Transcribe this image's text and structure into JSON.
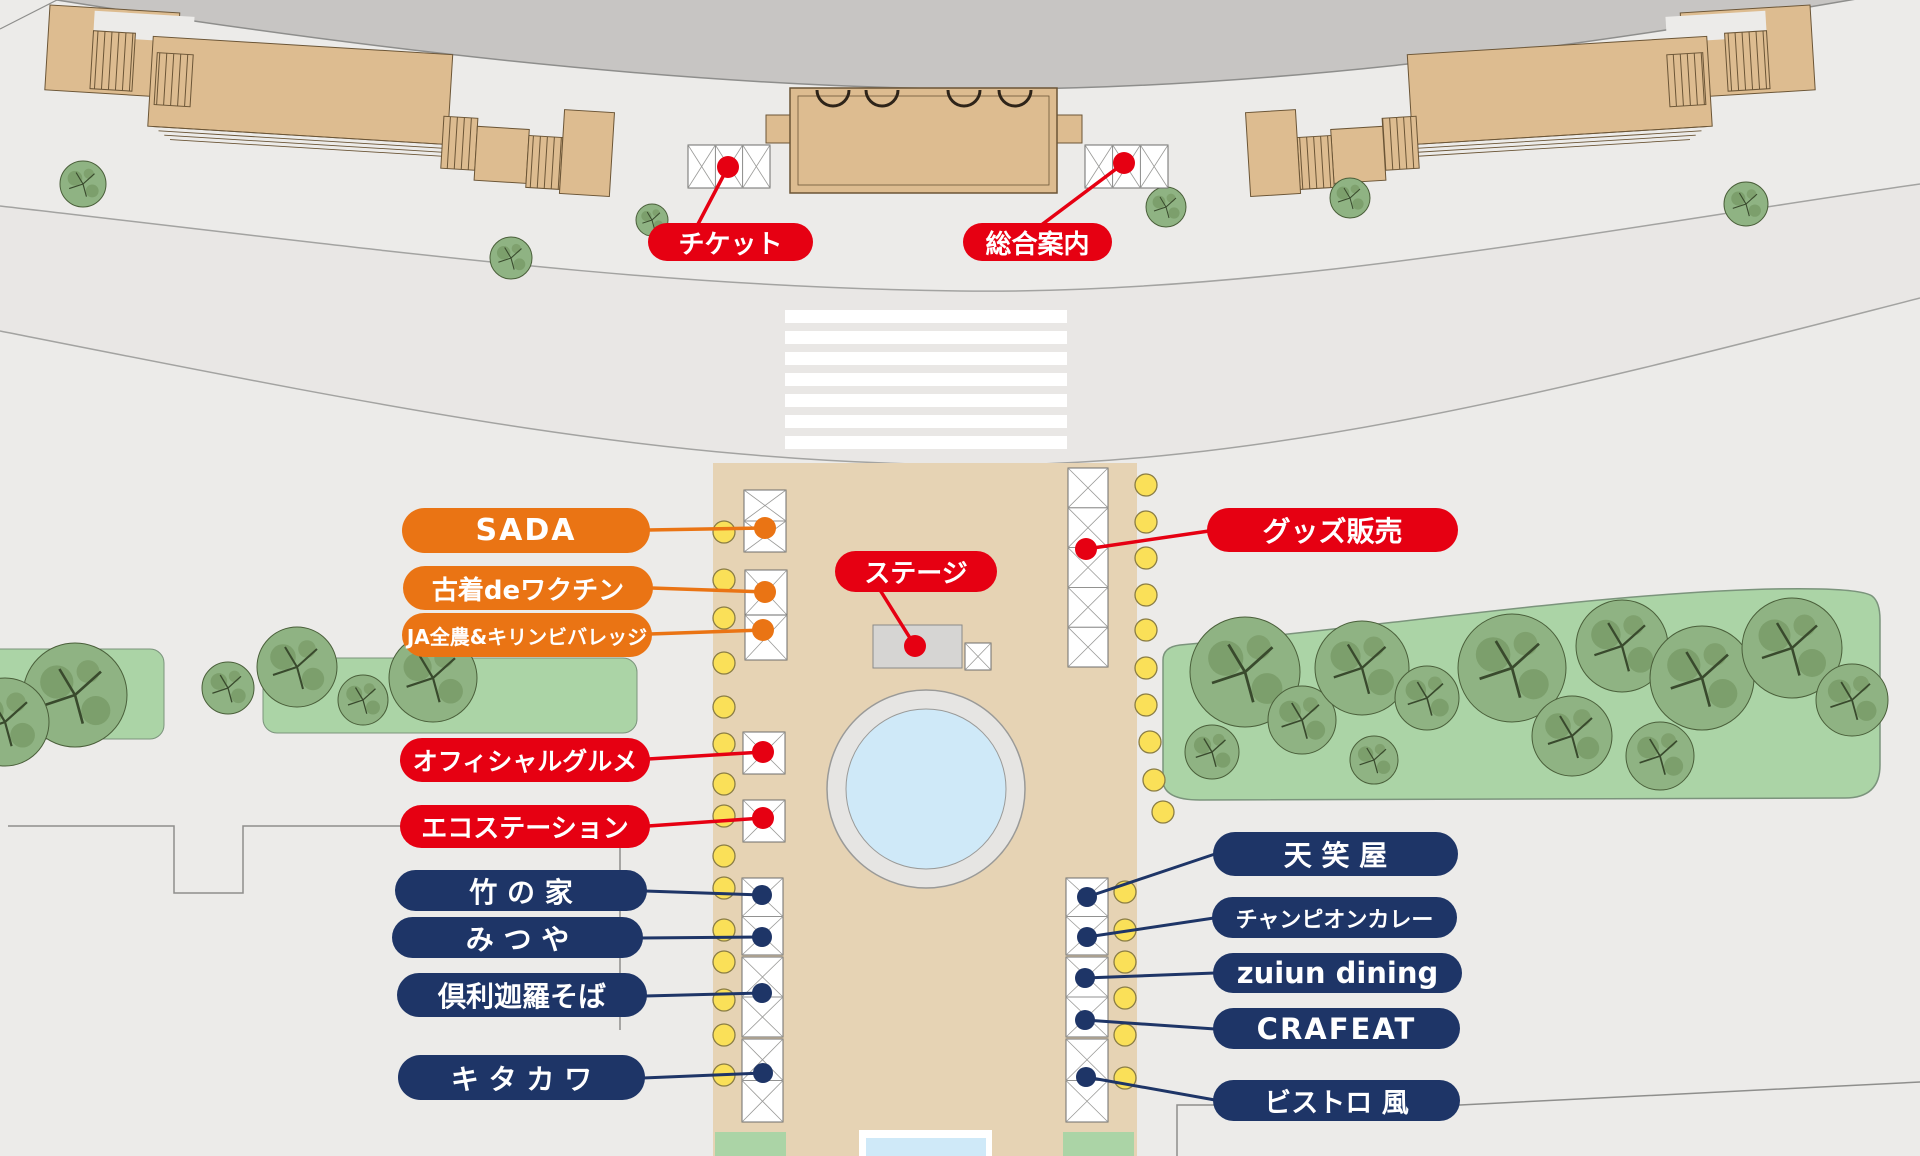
{
  "map_title": "event-venue-site-map",
  "colors": {
    "red": "#e60012",
    "orange": "#ea7414",
    "navy": "#1e3567",
    "bg": "#ecebe9",
    "road_band": "#c7c5c3",
    "road_fill": "#e9e7e5",
    "building_tan": "#ddbc90",
    "building_line": "#6b5536",
    "plaza_tan": "#e6d3b4",
    "green": "#abd4a6",
    "green_line": "#7b947c",
    "tree_fill": "#8fb383",
    "tree_dark": "#66884f",
    "water": "#cfe9f8",
    "stage_gray": "#d6d5d3",
    "lamp_yellow": "#fae058",
    "lamp_line": "#8a7d45",
    "tent_line": "#6e6e6c"
  },
  "icons": {
    "tent-icon": "white canopy grid with X bracing",
    "lamp-icon": "yellow circle",
    "tree-icon": "speckled green circle",
    "fountain-icon": "blue circle with gray ring",
    "crosswalk-icon": "white zebra stripes"
  },
  "booths": {
    "ticket": {
      "label": "チケット",
      "pill_color": "red"
    },
    "info": {
      "label": "総合案内",
      "pill_color": "red"
    },
    "sada": {
      "label": "SADA",
      "pill_color": "orange"
    },
    "furugi_vaccine": {
      "label": "古着deワクチン",
      "pill_color": "orange"
    },
    "ja_kirin": {
      "label": "JA全農&キリンビバレッジ",
      "pill_color": "orange"
    },
    "stage": {
      "label": "ステージ",
      "pill_color": "red"
    },
    "goods": {
      "label": "グッズ販売",
      "pill_color": "red"
    },
    "official_gourmet": {
      "label": "オフィシャルグルメ",
      "pill_color": "red"
    },
    "eco_station": {
      "label": "エコステーション",
      "pill_color": "red"
    },
    "take_no_ie": {
      "label": "竹 の 家",
      "pill_color": "navy"
    },
    "mitsuya": {
      "label": "み つ や",
      "pill_color": "navy"
    },
    "kurikara_soba": {
      "label": "倶利迦羅そば",
      "pill_color": "navy"
    },
    "kitakawa": {
      "label": "キ タ カ ワ",
      "pill_color": "navy"
    },
    "tenshoya": {
      "label": "天 笑 屋",
      "pill_color": "navy"
    },
    "champion_curry": {
      "label": "チャンピオンカレー",
      "pill_color": "navy"
    },
    "zuiun_dining": {
      "label": "zuiun dining",
      "pill_color": "navy"
    },
    "crafeat": {
      "label": "CRAFEAT",
      "pill_color": "navy"
    },
    "bistro_kaze": {
      "label": "ビストロ 風",
      "pill_color": "navy"
    }
  }
}
